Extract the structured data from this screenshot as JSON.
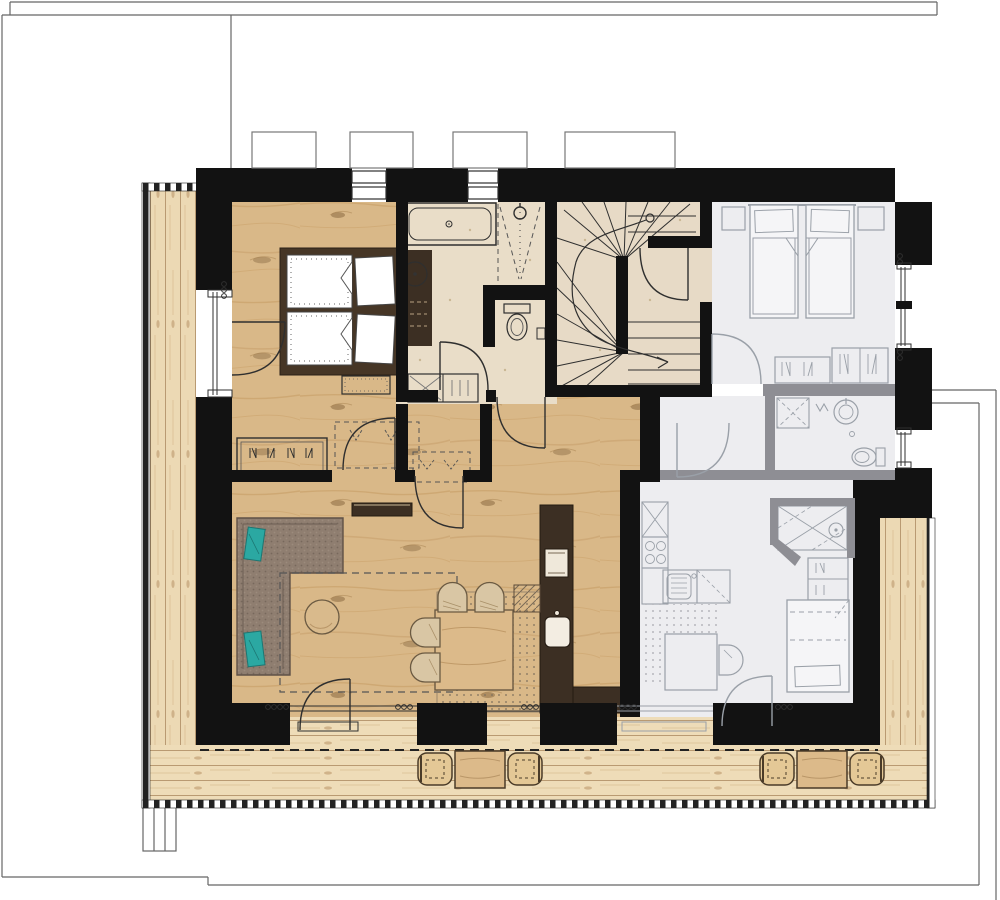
{
  "document": {
    "kind": "architectural-floor-plan",
    "visible_text": [],
    "notes": "plan drawing only – no text labels rendered in the image"
  },
  "palette": {
    "wall": "#121212",
    "greyWall": "#8e8e94",
    "line": "#2f2f2f",
    "greyLine": "#9aa0a8",
    "site": "#666666",
    "wood": "#d9b888",
    "woodStreak": "#c49a63",
    "deck": "#ecd9b4",
    "deckLine": "#b99a72",
    "tile": "#e9ddc8",
    "greyFloor": "#ededf0",
    "darkFurn": "#3c2f23",
    "bedFrame": "#463626",
    "sofa": "#8f7e70",
    "teal": "#2ba8a2",
    "chair": "#d9c6a4",
    "tableWood": "#dcba8a",
    "boundary": "#222222"
  },
  "plan": {
    "shared_elements": [
      "staircase",
      "terrace-deck",
      "property-boundary",
      "site-outline"
    ],
    "units": [
      {
        "id": "apartment",
        "style": "active",
        "rooms": [
          "bedroom",
          "bathroom",
          "hall",
          "living-dining",
          "kitchen"
        ],
        "fixtures": [
          "double-bed",
          "wardrobe",
          "bathtub",
          "shower",
          "washbasin",
          "toilet",
          "corner-sofa",
          "coffee-table",
          "rug",
          "tv-sideboard",
          "dining-table",
          "dining-chair",
          "kitchen-counter",
          "kitchen-sink"
        ]
      },
      {
        "id": "neighbor-unit",
        "style": "greyed-out",
        "rooms": [
          "bedroom",
          "bathroom",
          "shower-room",
          "kitchen-living"
        ],
        "fixtures": [
          "twin-bed",
          "nightstand",
          "dresser",
          "wardrobe",
          "shower",
          "washbasin",
          "toilet",
          "hob",
          "kitchen-sink",
          "table",
          "chair",
          "single-bed"
        ]
      }
    ],
    "terrace_furniture": [
      "outdoor-table",
      "outdoor-chair"
    ]
  }
}
